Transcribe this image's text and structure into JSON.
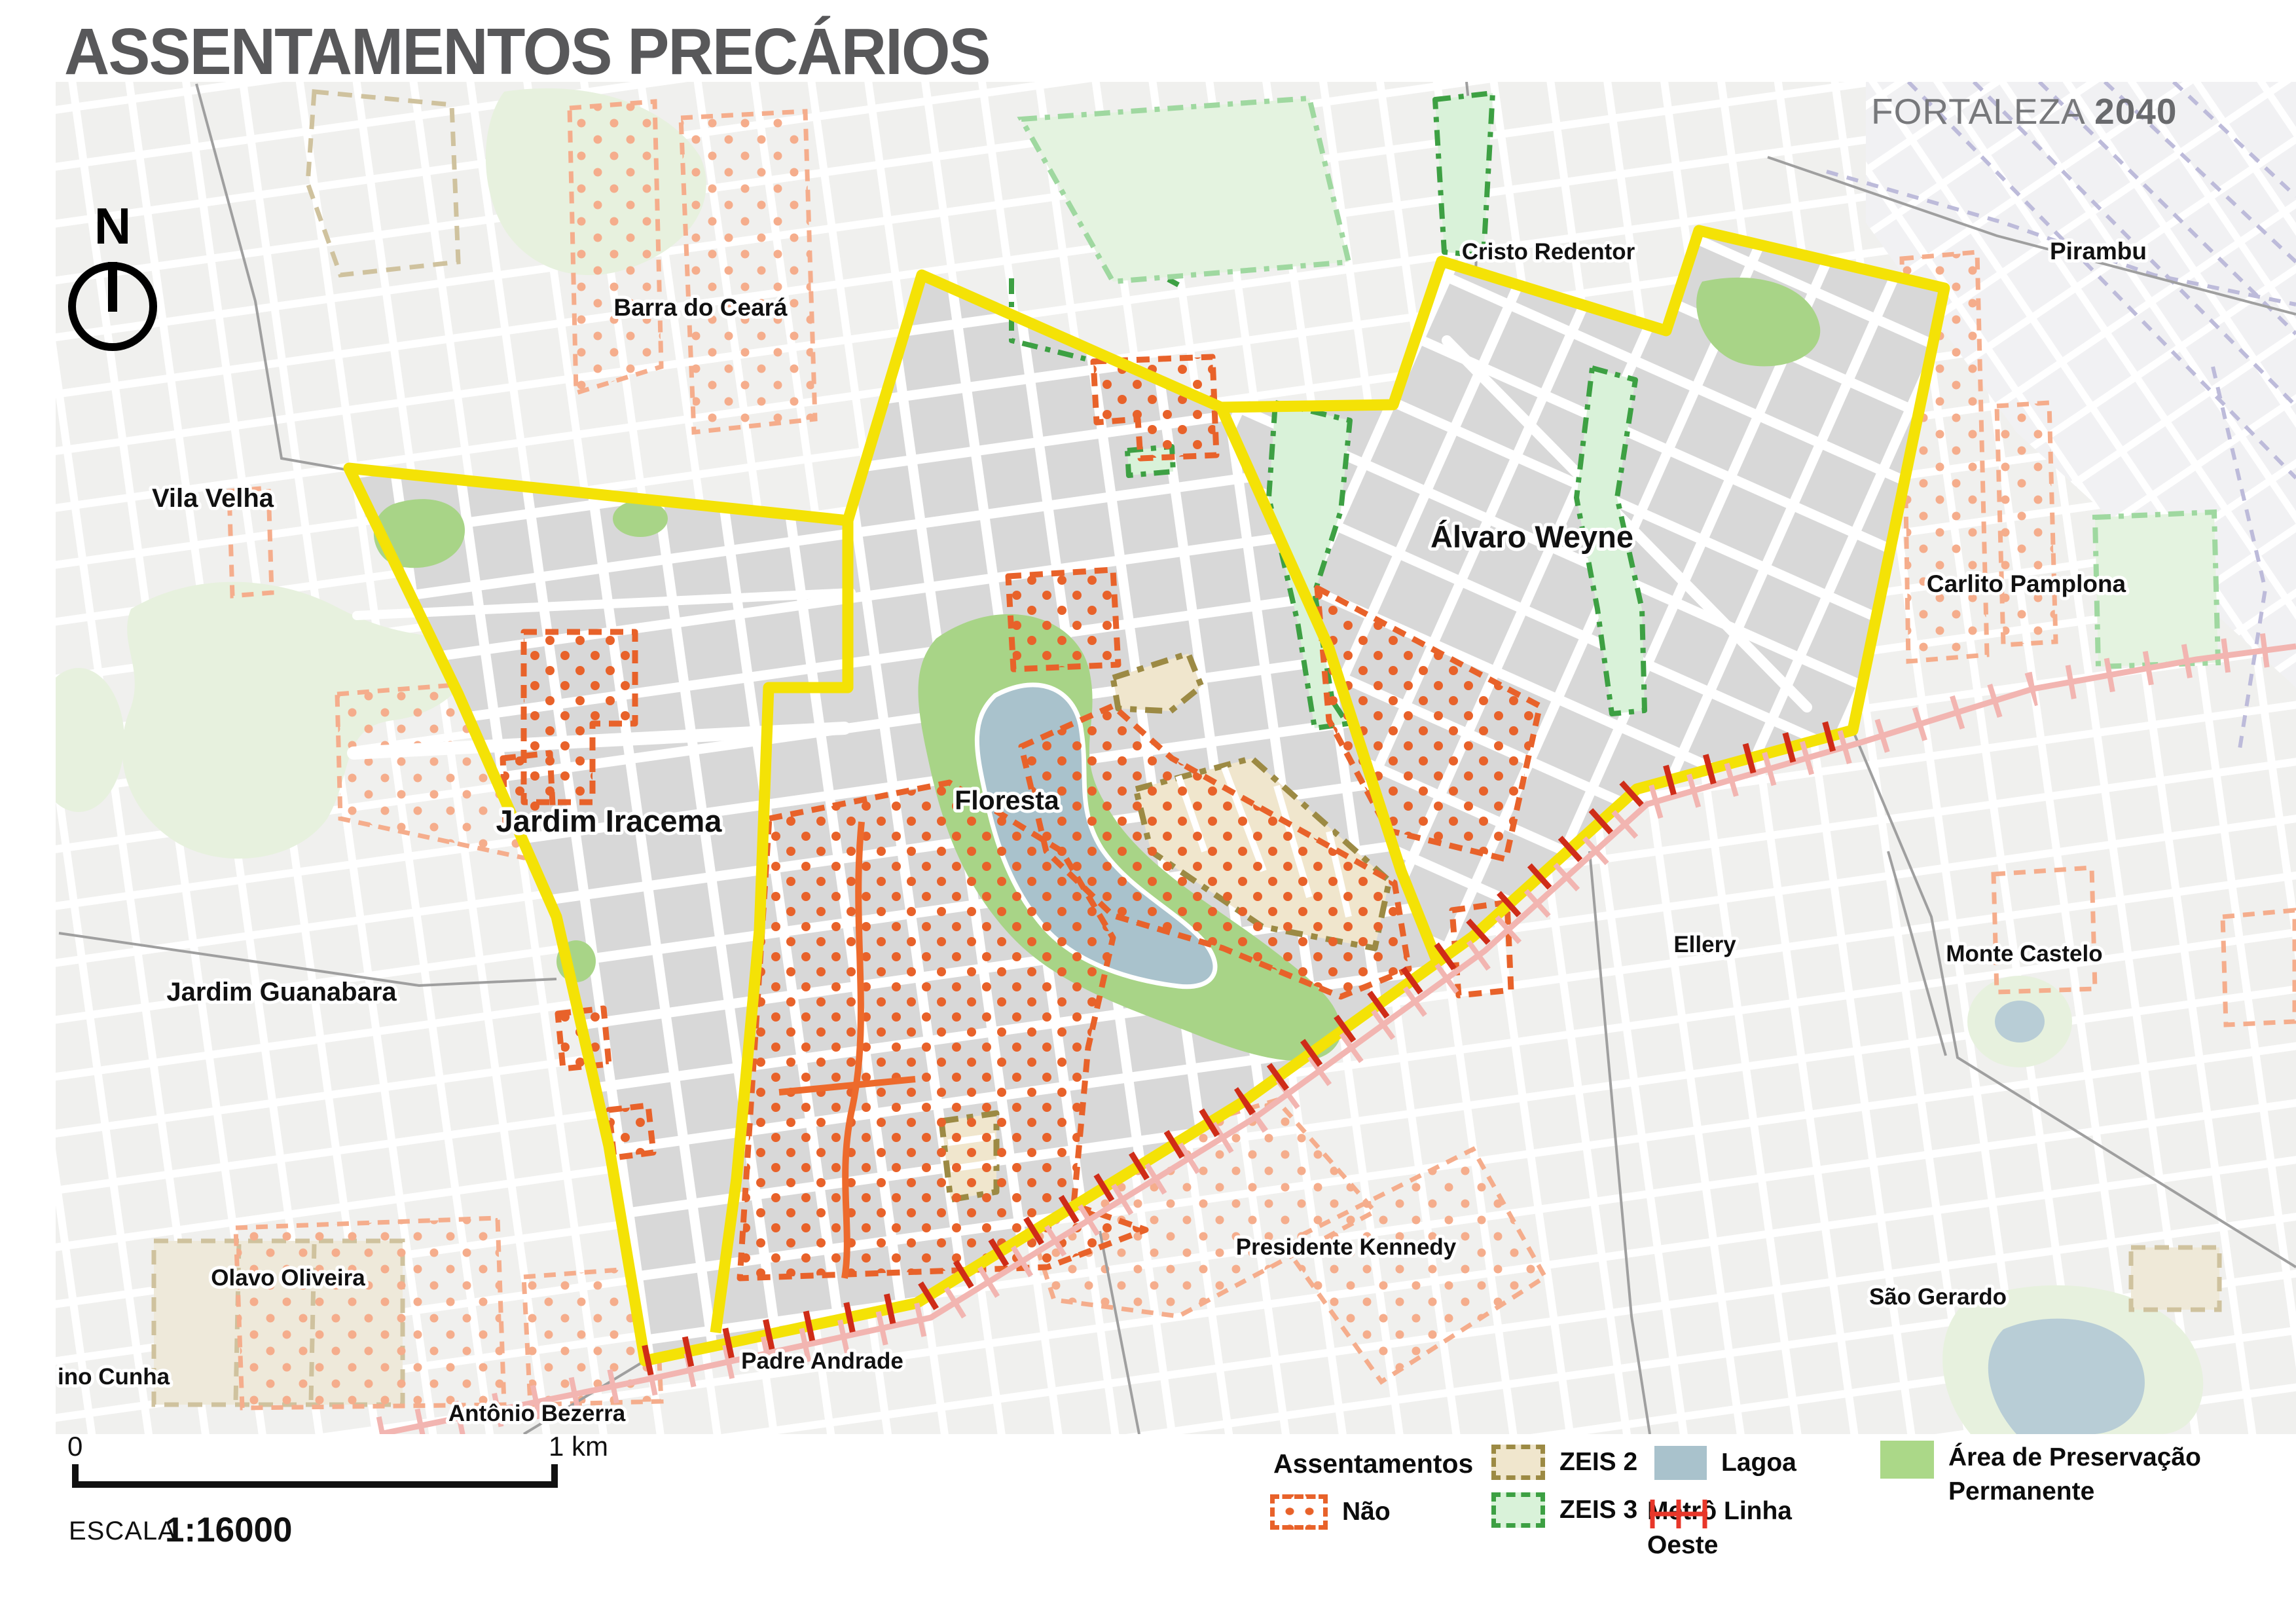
{
  "title": "ASSENTAMENTOS PRECÁRIOS",
  "brand": {
    "city": "FORTALEZA",
    "year": "2040"
  },
  "north_indicator": "N",
  "scale": {
    "zero": "0",
    "one_km": "1 km",
    "escala": "ESCALA",
    "ratio": "1:16000"
  },
  "legend": {
    "assentamentos": "Assentamentos",
    "nao": "Não",
    "zeis2": "ZEIS 2",
    "zeis3": "ZEIS 3",
    "lagoa": "Lagoa",
    "metro_line1": "Metrô Linha",
    "metro_line2": "Oeste",
    "app_line1": "Área de Preservação",
    "app_line2": "Permanente"
  },
  "labels": {
    "barra": "Barra do Ceará",
    "cristo": "Cristo Redentor",
    "pirambu": "Pirambu",
    "vila_velha": "Vila Velha",
    "alvaro": "Álvaro Weyne",
    "carlito": "Carlito Pamplona",
    "jardim_iracema": "Jardim Iracema",
    "floresta": "Floresta",
    "jardim_guanabara": "Jardim Guanabara",
    "ellery": "Ellery",
    "monte_castelo": "Monte Castelo",
    "olavo": "Olavo Oliveira",
    "sao_gerardo": "São Gerardo",
    "kennedy": "Presidente Kennedy",
    "padre_andrade": "Padre Andrade",
    "antonio_bezerra": "Antônio Bezerra",
    "cunha": "ino Cunha"
  },
  "colors": {
    "boundary_yellow": "#F4E206",
    "settlement_orange": "#E8622A",
    "settlement_orange_light": "#F5AD8C",
    "zeis2_fill": "#F0E6CD",
    "zeis2_border": "#9C8A44",
    "zeis3_fill": "#D9F2D9",
    "zeis3_border": "#3DA043",
    "lagoa_blue": "#A9C2CC",
    "app_green": "#A8D487",
    "app_green_pale": "#E7F1DE",
    "metro_red": "#E8372A",
    "metro_pink": "#F2B5B1",
    "blocks_inside": "#D8D8D8",
    "blocks_outside": "#F0F0EE",
    "title_gray": "#58585A"
  }
}
